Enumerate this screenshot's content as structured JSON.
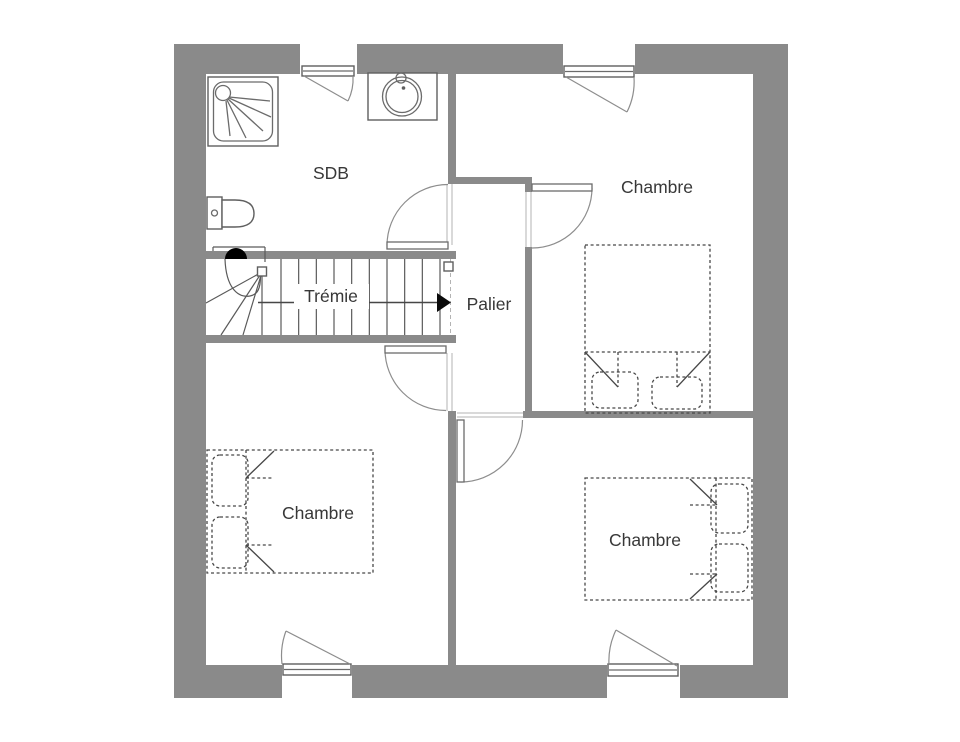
{
  "plan": {
    "type": "floor-plan",
    "rooms": [
      {
        "id": "sdb",
        "label": "SDB"
      },
      {
        "id": "chambre-top-right",
        "label": "Chambre"
      },
      {
        "id": "tremie",
        "label": "Trémie"
      },
      {
        "id": "palier",
        "label": "Palier"
      },
      {
        "id": "chambre-bottom-left",
        "label": "Chambre"
      },
      {
        "id": "chambre-bottom-right",
        "label": "Chambre"
      }
    ],
    "stairs": {
      "label": "Trémie",
      "tread_count": 10,
      "winder_lines": 3,
      "direction": "right"
    },
    "fixtures": [
      {
        "icon": "shower-tray-icon",
        "room": "SDB"
      },
      {
        "icon": "washbasin-icon",
        "room": "SDB"
      },
      {
        "icon": "toilet-icon",
        "room": "SDB"
      },
      {
        "icon": "double-bed-icon",
        "room": "Chambre (top right)"
      },
      {
        "icon": "double-bed-icon",
        "room": "Chambre (bottom left)"
      },
      {
        "icon": "double-bed-icon",
        "room": "Chambre (bottom right)"
      }
    ],
    "openings": {
      "windows": 4,
      "doors": 4
    },
    "colors": {
      "wall": "#8a8a8a",
      "background": "#ffffff",
      "line": "#6b6b6b",
      "text": "#383838",
      "arrow": "#0a0a0a"
    }
  }
}
